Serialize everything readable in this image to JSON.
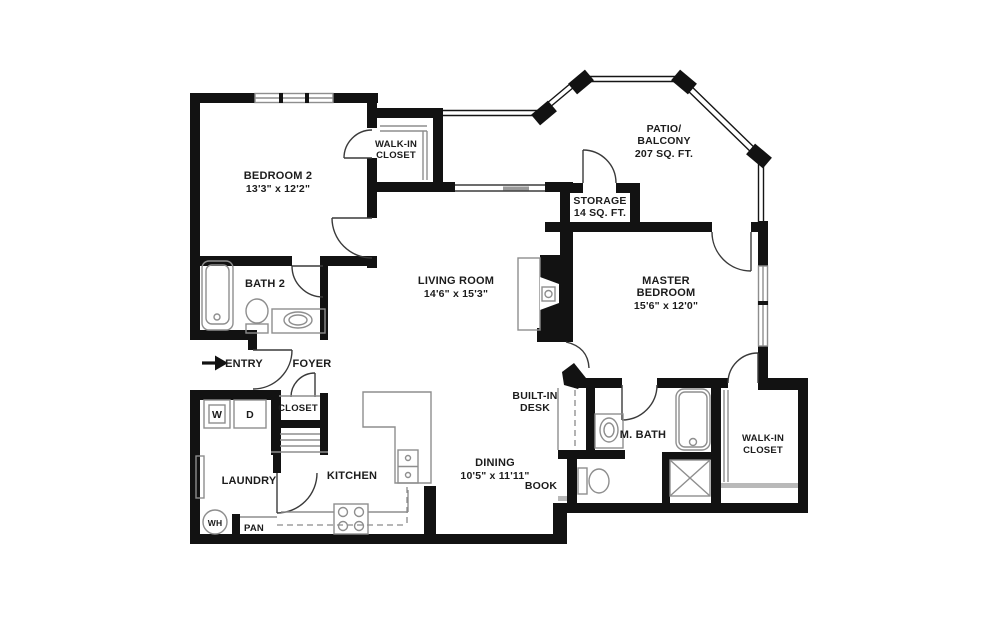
{
  "plan": {
    "type": "apartment floor plan",
    "colors": {
      "walls": "#121212",
      "fixtures": "#8e8e8e",
      "background": "#ffffff",
      "text": "#1c1c1c"
    },
    "rooms": {
      "bedroom2": {
        "name": "BEDROOM 2",
        "dims": "13'3\" x 12'2\""
      },
      "walkin_top": {
        "line1": "WALK-IN",
        "line2": "CLOSET"
      },
      "bath2": {
        "name": "BATH 2"
      },
      "living": {
        "name": "LIVING ROOM",
        "dims": "14'6\" x 15'3\""
      },
      "patio": {
        "line1": "PATIO/",
        "line2": "BALCONY",
        "area": "207 SQ. FT."
      },
      "storage": {
        "name": "STORAGE",
        "area": "14 SQ. FT."
      },
      "master": {
        "line1": "MASTER",
        "line2": "BEDROOM",
        "dims": "15'6\" x 12'0\""
      },
      "mbath": {
        "name": "M. BATH"
      },
      "walkin_master": {
        "line1": "WALK-IN",
        "line2": "CLOSET"
      },
      "dining": {
        "name": "DINING",
        "dims": "10'5\" x 11'11\""
      },
      "desk": {
        "line1": "BUILT-IN",
        "line2": "DESK"
      },
      "book": {
        "name": "BOOK"
      },
      "kitchen": {
        "name": "KITCHEN"
      },
      "foyer": {
        "name": "FOYER"
      },
      "entry": {
        "name": "ENTRY"
      },
      "closet": {
        "name": "CLOSET"
      },
      "laundry": {
        "name": "LAUNDRY"
      },
      "pantry": {
        "name": "PAN"
      },
      "water_heater": {
        "name": "WH"
      },
      "washer": {
        "name": "W"
      },
      "dryer": {
        "name": "D"
      }
    }
  }
}
